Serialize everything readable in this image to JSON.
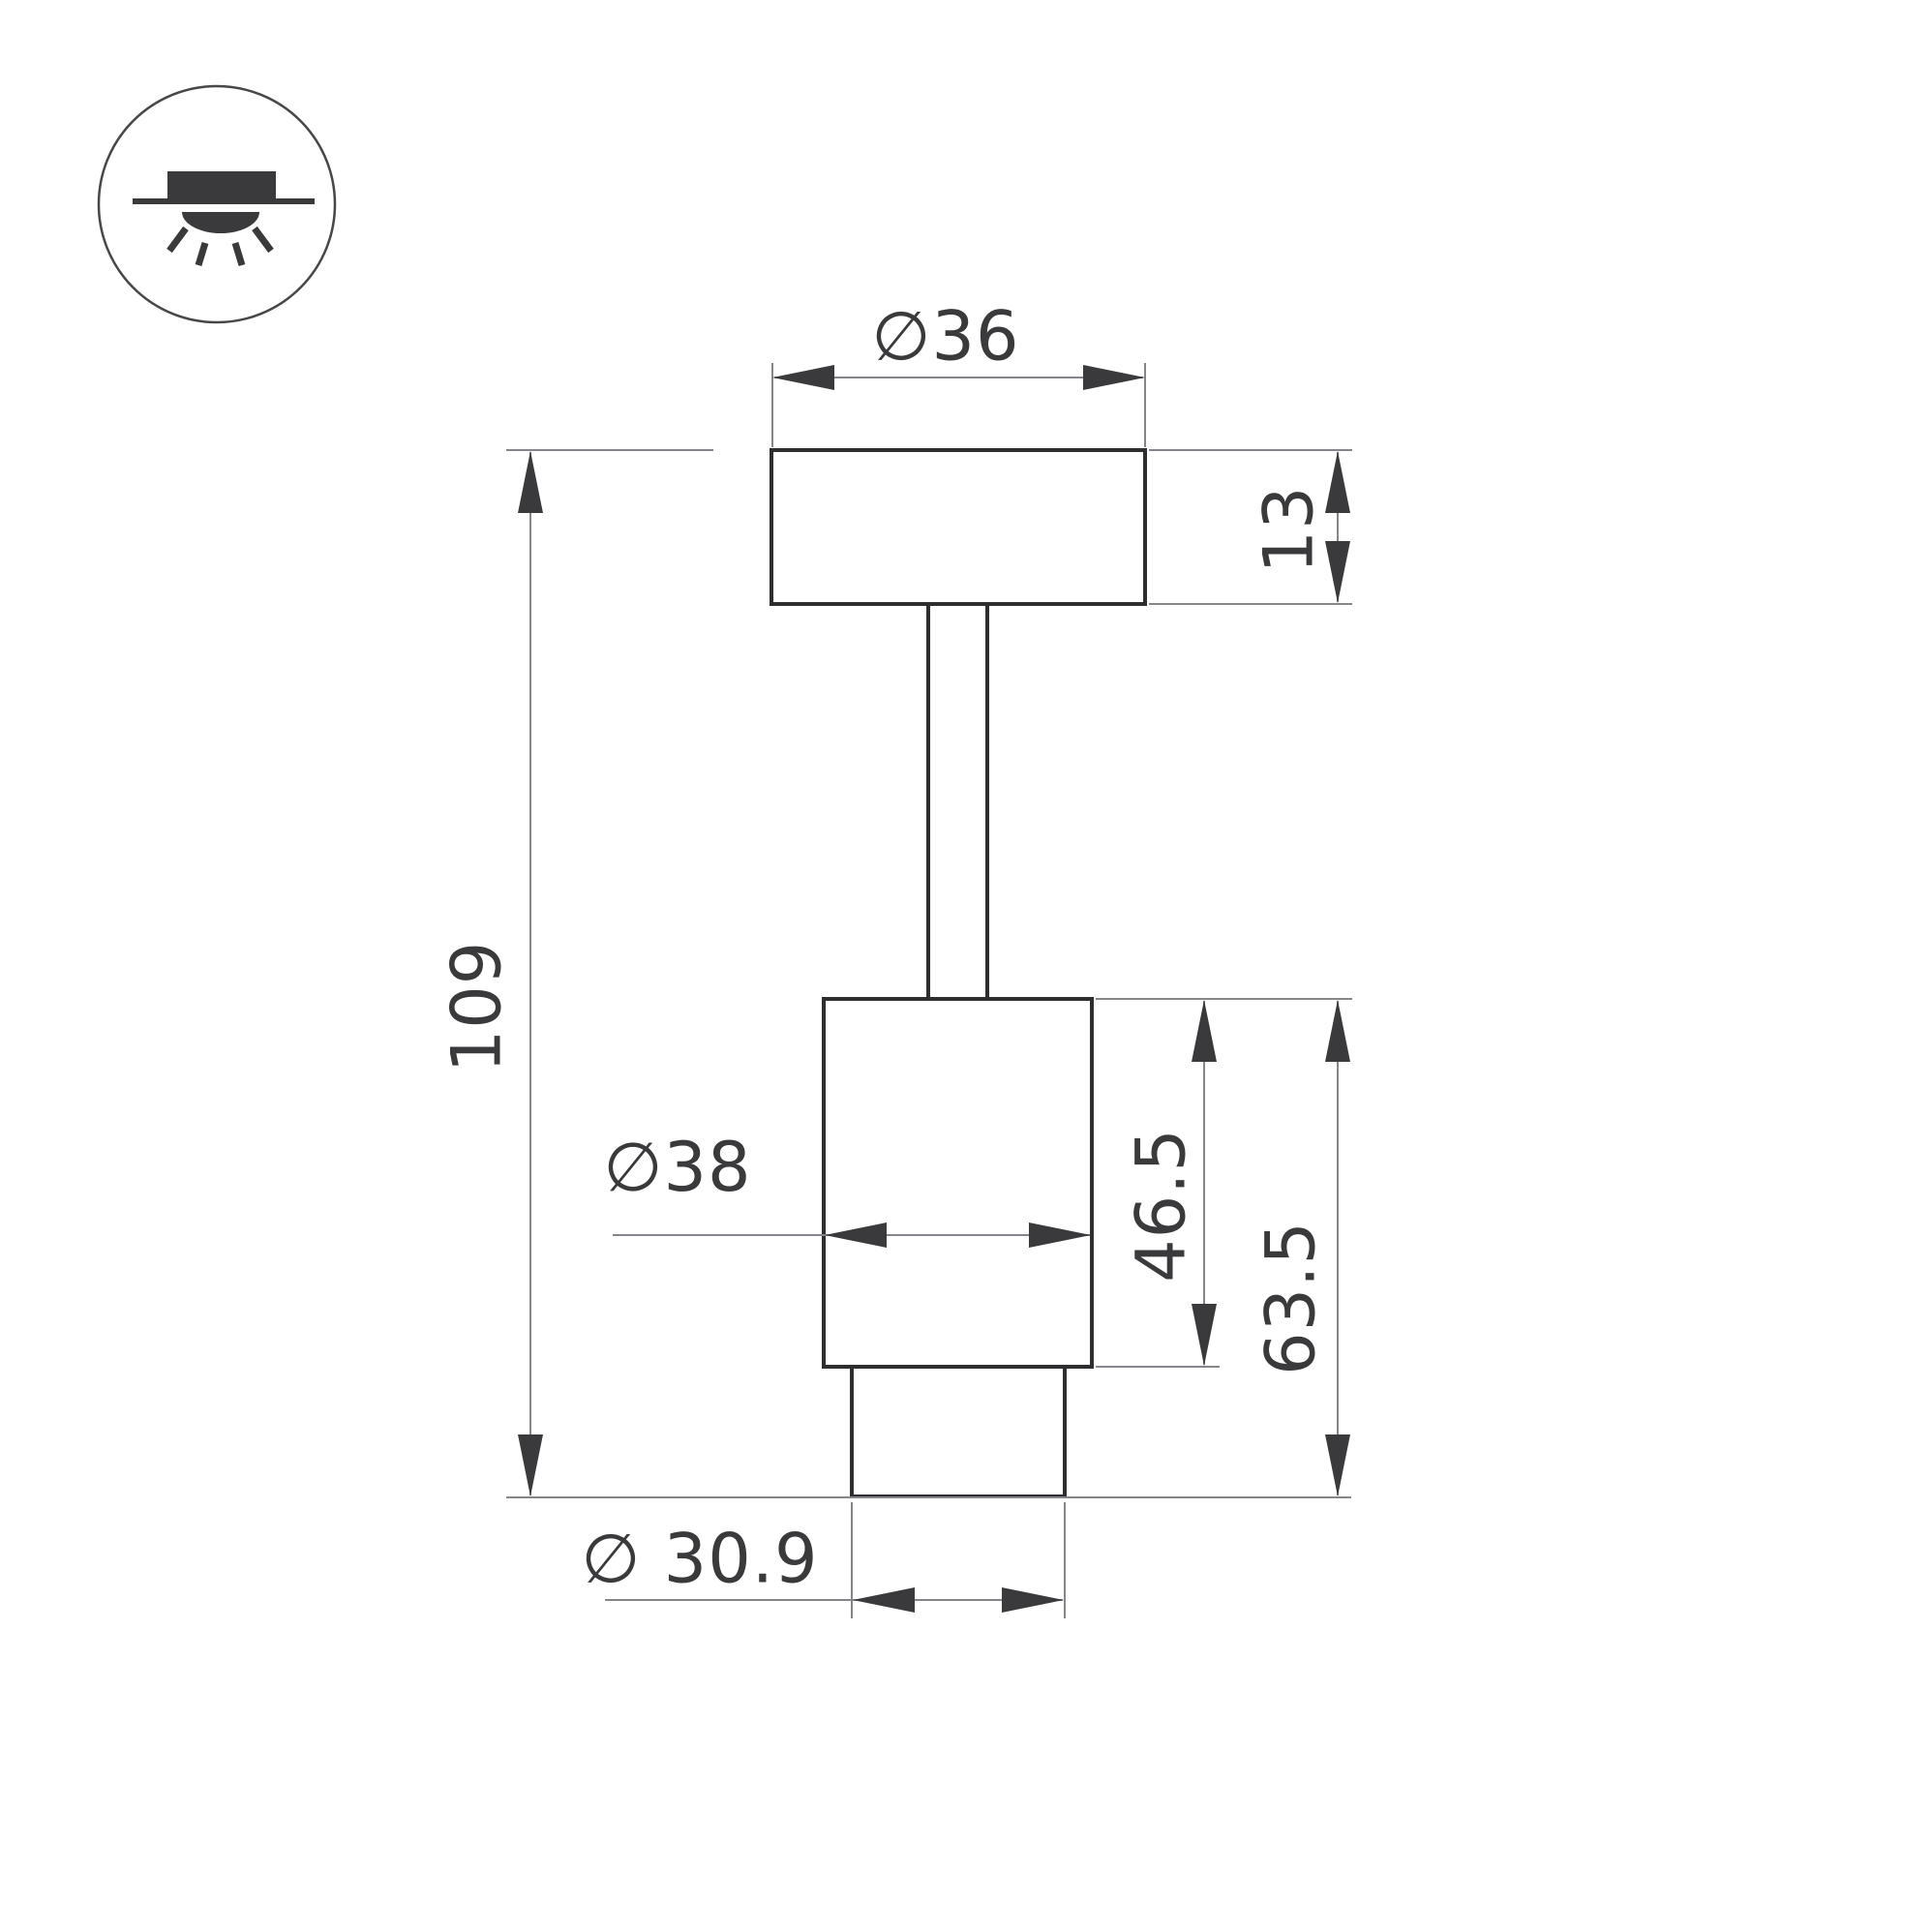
{
  "page": {
    "background": "#ffffff",
    "title": "luminaire-dimension-drawing"
  },
  "icon_legend": {
    "meaning": "surface-mounted-downlight-symbol"
  },
  "drawing": {
    "labels": {
      "top_diameter": "∅36",
      "cap_height": "13",
      "overall_height": "109",
      "body_diameter": "∅38",
      "body_height": "46.5",
      "lower_section_height": "63.5",
      "bottom_diameter": "∅ 30.9"
    },
    "colors": {
      "outline": "#2e2e30",
      "dimension_line": "#85858b",
      "arrow_and_text": "#3a3a3d"
    }
  }
}
